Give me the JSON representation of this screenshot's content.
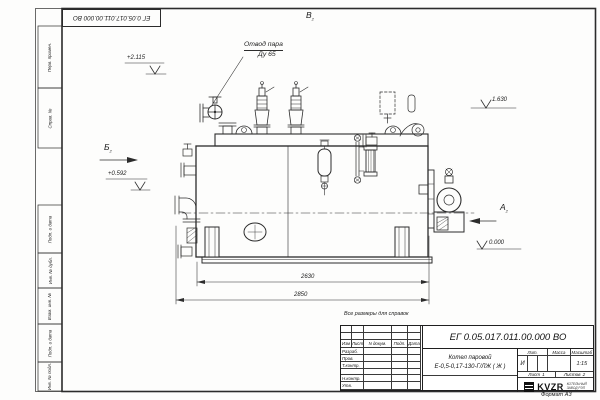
{
  "colors": {
    "line": "#2c2c2c",
    "paper": "#fdfdfc"
  },
  "sheet": {
    "designation_flipped": "ЕГ 0.05.017.011.00.000  ВО",
    "note": "Все размеры для справок",
    "format": "Формат А3"
  },
  "margin": {
    "items": [
      "Перв. примен.",
      "Справ. №",
      "Подп. и дата",
      "Инв. № дубл.",
      "Взам. инв. №",
      "Подп. и дата",
      "Инв. № подл."
    ]
  },
  "drawing": {
    "callout": {
      "line1": "Отвод пара",
      "line2": "Ду 65"
    },
    "levels": {
      "top": "+2.115",
      "mid": "+0.592",
      "right": "1.630",
      "zero": "0.000"
    },
    "views": {
      "b": "Б",
      "a": "А",
      "v": "В",
      "sub": "2"
    },
    "dims": {
      "inner": "2630",
      "outer": "2850"
    }
  },
  "titleblock": {
    "designation": "ЕГ 0.05.017.011.00.000  ВО",
    "product_line1": "Котел паровой",
    "product_line2": "Е-0,5-0,17-130-Г/ЛЖ ( Ж )",
    "col_headers": [
      "Изм",
      "Лист",
      "N докум.",
      "Подп.",
      "Дата"
    ],
    "roles": [
      "Разраб.",
      "Пров.",
      "Т.контр.",
      "Н.контр.",
      "Утв."
    ],
    "lit_header": "Лит.",
    "mass_header": "Масса",
    "scale_header": "Масштаб",
    "lit_value": "И",
    "scale_value": "1:15",
    "sheet_label": "Лист",
    "sheet_value": "1",
    "sheets_label": "Листов",
    "sheets_value": "2",
    "brand": "KVZR",
    "brand_sub1": "КОТЕЛЬНЫЙ",
    "brand_sub2": "ЗАВОД РЭП"
  }
}
